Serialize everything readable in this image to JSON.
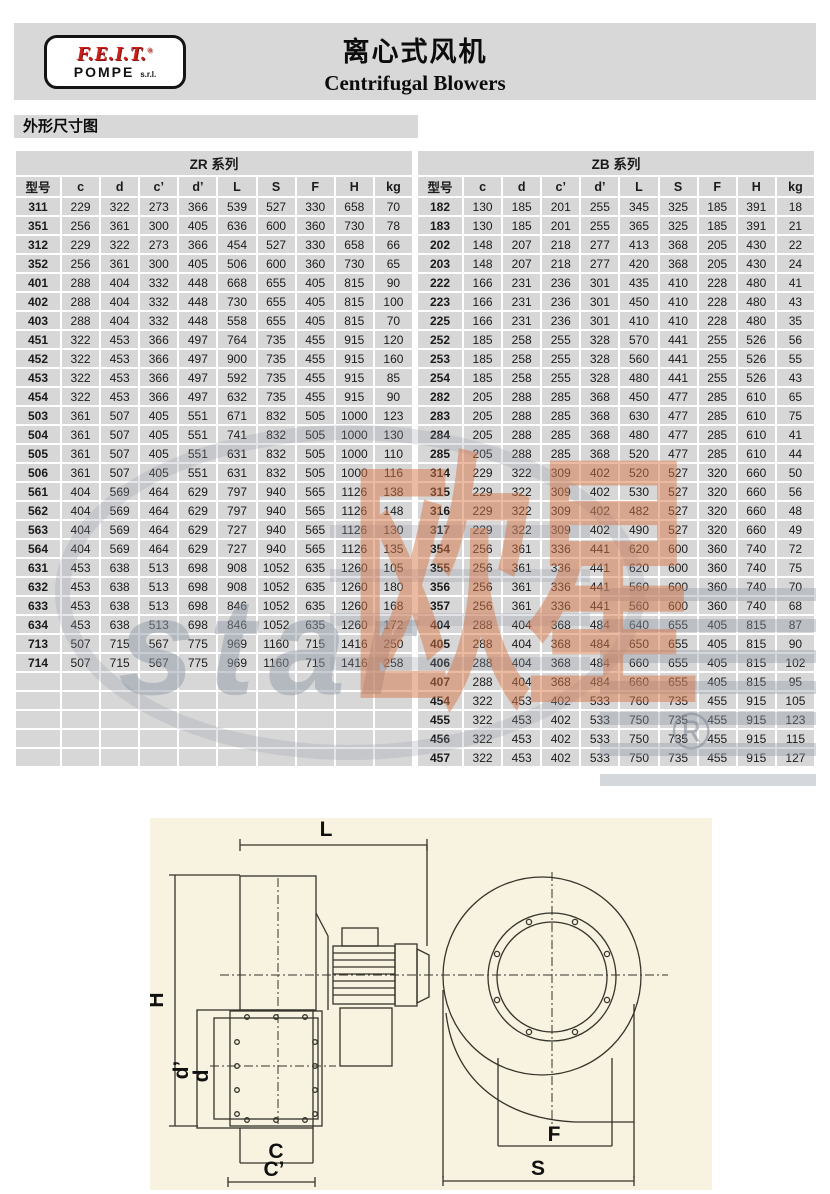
{
  "header": {
    "logo_line1": "F.E.I.T.",
    "logo_reg": "®",
    "logo_line2": "POMPE",
    "logo_suffix": "s.r.l.",
    "title_cn": "离心式风机",
    "title_en": "Centrifugal Blowers"
  },
  "section_label": "外形尺寸图",
  "table": {
    "col_headers": [
      "型号",
      "c",
      "d",
      "c’",
      "d’",
      "L",
      "S",
      "F",
      "H",
      "kg"
    ],
    "zr": {
      "title": "ZR 系列",
      "empty_rows": 5,
      "rows": [
        [
          "311",
          229,
          322,
          273,
          366,
          539,
          527,
          330,
          658,
          70
        ],
        [
          "351",
          256,
          361,
          300,
          405,
          636,
          600,
          360,
          730,
          78
        ],
        [
          "312",
          229,
          322,
          273,
          366,
          454,
          527,
          330,
          658,
          66
        ],
        [
          "352",
          256,
          361,
          300,
          405,
          506,
          600,
          360,
          730,
          65
        ],
        [
          "401",
          288,
          404,
          332,
          448,
          668,
          655,
          405,
          815,
          90
        ],
        [
          "402",
          288,
          404,
          332,
          448,
          730,
          655,
          405,
          815,
          100
        ],
        [
          "403",
          288,
          404,
          332,
          448,
          558,
          655,
          405,
          815,
          70
        ],
        [
          "451",
          322,
          453,
          366,
          497,
          764,
          735,
          455,
          915,
          120
        ],
        [
          "452",
          322,
          453,
          366,
          497,
          900,
          735,
          455,
          915,
          160
        ],
        [
          "453",
          322,
          453,
          366,
          497,
          592,
          735,
          455,
          915,
          85
        ],
        [
          "454",
          322,
          453,
          366,
          497,
          632,
          735,
          455,
          915,
          90
        ],
        [
          "503",
          361,
          507,
          405,
          551,
          671,
          832,
          505,
          1000,
          123
        ],
        [
          "504",
          361,
          507,
          405,
          551,
          741,
          832,
          505,
          1000,
          130
        ],
        [
          "505",
          361,
          507,
          405,
          551,
          631,
          832,
          505,
          1000,
          110
        ],
        [
          "506",
          361,
          507,
          405,
          551,
          631,
          832,
          505,
          1000,
          116
        ],
        [
          "561",
          404,
          569,
          464,
          629,
          797,
          940,
          565,
          1126,
          138
        ],
        [
          "562",
          404,
          569,
          464,
          629,
          797,
          940,
          565,
          1126,
          148
        ],
        [
          "563",
          404,
          569,
          464,
          629,
          727,
          940,
          565,
          1126,
          130
        ],
        [
          "564",
          404,
          569,
          464,
          629,
          727,
          940,
          565,
          1126,
          135
        ],
        [
          "631",
          453,
          638,
          513,
          698,
          908,
          1052,
          635,
          1260,
          105
        ],
        [
          "632",
          453,
          638,
          513,
          698,
          908,
          1052,
          635,
          1260,
          180
        ],
        [
          "633",
          453,
          638,
          513,
          698,
          846,
          1052,
          635,
          1260,
          168
        ],
        [
          "634",
          453,
          638,
          513,
          698,
          846,
          1052,
          635,
          1260,
          172
        ],
        [
          "713",
          507,
          715,
          567,
          775,
          969,
          1160,
          715,
          1416,
          250
        ],
        [
          "714",
          507,
          715,
          567,
          775,
          969,
          1160,
          715,
          1416,
          258
        ]
      ]
    },
    "zb": {
      "title": "ZB 系列",
      "empty_rows": 0,
      "rows": [
        [
          "182",
          130,
          185,
          201,
          255,
          345,
          325,
          185,
          391,
          18
        ],
        [
          "183",
          130,
          185,
          201,
          255,
          365,
          325,
          185,
          391,
          21
        ],
        [
          "202",
          148,
          207,
          218,
          277,
          413,
          368,
          205,
          430,
          22
        ],
        [
          "203",
          148,
          207,
          218,
          277,
          420,
          368,
          205,
          430,
          24
        ],
        [
          "222",
          166,
          231,
          236,
          301,
          435,
          410,
          228,
          480,
          41
        ],
        [
          "223",
          166,
          231,
          236,
          301,
          450,
          410,
          228,
          480,
          43
        ],
        [
          "225",
          166,
          231,
          236,
          301,
          410,
          410,
          228,
          480,
          35
        ],
        [
          "252",
          185,
          258,
          255,
          328,
          570,
          441,
          255,
          526,
          56
        ],
        [
          "253",
          185,
          258,
          255,
          328,
          560,
          441,
          255,
          526,
          55
        ],
        [
          "254",
          185,
          258,
          255,
          328,
          480,
          441,
          255,
          526,
          43
        ],
        [
          "282",
          205,
          288,
          285,
          368,
          450,
          477,
          285,
          610,
          65
        ],
        [
          "283",
          205,
          288,
          285,
          368,
          630,
          477,
          285,
          610,
          75
        ],
        [
          "284",
          205,
          288,
          285,
          368,
          480,
          477,
          285,
          610,
          41
        ],
        [
          "285",
          205,
          288,
          285,
          368,
          520,
          477,
          285,
          610,
          44
        ],
        [
          "314",
          229,
          322,
          309,
          402,
          520,
          527,
          320,
          660,
          50
        ],
        [
          "315",
          229,
          322,
          309,
          402,
          530,
          527,
          320,
          660,
          56
        ],
        [
          "316",
          229,
          322,
          309,
          402,
          482,
          527,
          320,
          660,
          48
        ],
        [
          "317",
          229,
          322,
          309,
          402,
          490,
          527,
          320,
          660,
          49
        ],
        [
          "354",
          256,
          361,
          336,
          441,
          620,
          600,
          360,
          740,
          72
        ],
        [
          "355",
          256,
          361,
          336,
          441,
          620,
          600,
          360,
          740,
          75
        ],
        [
          "356",
          256,
          361,
          336,
          441,
          560,
          600,
          360,
          740,
          70
        ],
        [
          "357",
          256,
          361,
          336,
          441,
          560,
          600,
          360,
          740,
          68
        ],
        [
          "404",
          288,
          404,
          368,
          484,
          640,
          655,
          405,
          815,
          87
        ],
        [
          "405",
          288,
          404,
          368,
          484,
          650,
          655,
          405,
          815,
          90
        ],
        [
          "406",
          288,
          404,
          368,
          484,
          660,
          655,
          405,
          815,
          102
        ],
        [
          "407",
          288,
          404,
          368,
          484,
          660,
          655,
          405,
          815,
          95
        ],
        [
          "454",
          322,
          453,
          402,
          533,
          760,
          735,
          455,
          915,
          105
        ],
        [
          "455",
          322,
          453,
          402,
          533,
          750,
          735,
          455,
          915,
          123
        ],
        [
          "456",
          322,
          453,
          402,
          533,
          750,
          735,
          455,
          915,
          115
        ],
        [
          "457",
          322,
          453,
          402,
          533,
          750,
          735,
          455,
          915,
          127
        ]
      ]
    }
  },
  "watermark": {
    "cn": "欧星",
    "en": "star",
    "reg": "®"
  },
  "diagram": {
    "labels": {
      "L": "L",
      "H": "H",
      "d_prime": "d’",
      "d": "d",
      "C": "C",
      "C_prime": "C’",
      "F": "F",
      "S": "S"
    }
  },
  "colors": {
    "band_gray": "#d8d8d8",
    "cell_gray": "#d7d7d7",
    "logo_red": "#cc1f1a",
    "diagram_cream": "#f8f2e0",
    "watermark_orange": "rgba(213,118,72,0.5)",
    "watermark_gray": "rgba(146,155,168,0.5)"
  }
}
